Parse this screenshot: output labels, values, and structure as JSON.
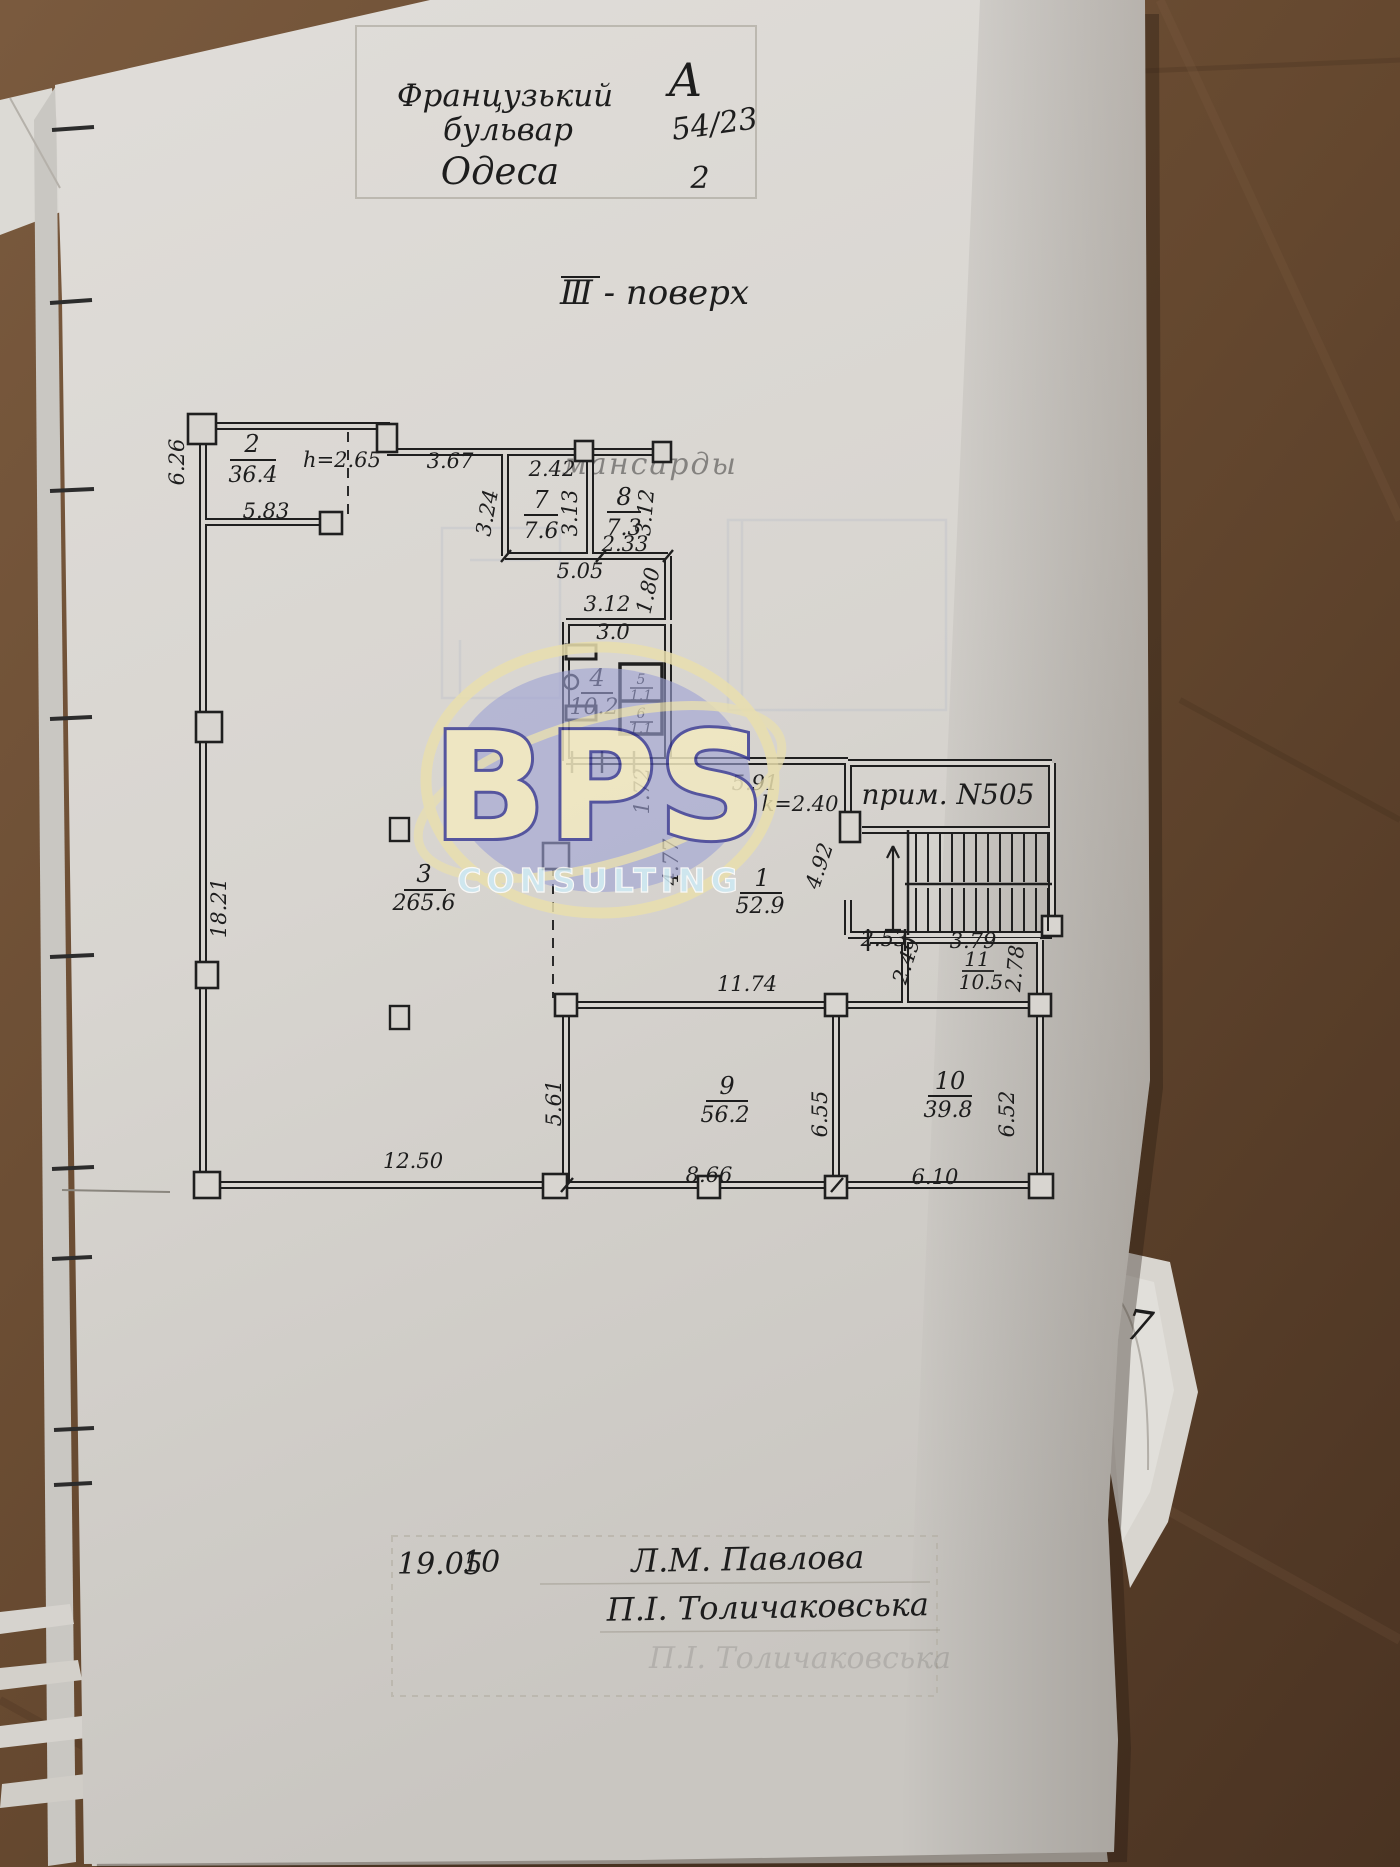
{
  "stamp": {
    "street_line1": "Французький",
    "street_line2": "бульвар",
    "city": "Одеса",
    "letter": "А",
    "house_number": "54/23",
    "copy_number": "2"
  },
  "title": "Ⅲ - поверх",
  "bleedthrough_text": "мансарды",
  "corner_note": "7",
  "logo": {
    "name": "BPS",
    "subtitle": "CONSULTING"
  },
  "plan": {
    "premise_label": "прим. N505",
    "rooms": [
      {
        "num": "1",
        "area": "52.9"
      },
      {
        "num": "2",
        "area": "36.4"
      },
      {
        "num": "3",
        "area": "265.6"
      },
      {
        "num": "4",
        "area": "10.2"
      },
      {
        "num": "5",
        "area": "1.1"
      },
      {
        "num": "6",
        "area": "1.1"
      },
      {
        "num": "7",
        "area": "7.6"
      },
      {
        "num": "8",
        "area": "7.3"
      },
      {
        "num": "9",
        "area": "56.2"
      },
      {
        "num": "10",
        "area": "39.8"
      },
      {
        "num": "11",
        "area": "10.5"
      }
    ],
    "dims": [
      "h=2.65",
      "3.67",
      "2.42",
      "6.26",
      "5.83",
      "3.24",
      "3.13",
      "3.12",
      "2.33",
      "5.05",
      "1.80",
      "3.12",
      "3.0",
      "18.21",
      "1.72",
      "5.91",
      "k=2.40",
      "4.77",
      "4.92",
      "2.53",
      "3.79",
      "2.49",
      "2.78",
      "11.74",
      "12.50",
      "5.61",
      "8.66",
      "6.55",
      "6.10",
      "6.52"
    ]
  },
  "footer": {
    "date": "19.05",
    "year": "10",
    "name1": "Л.М. Павлова",
    "name2": "П.І. Толичаковська"
  }
}
